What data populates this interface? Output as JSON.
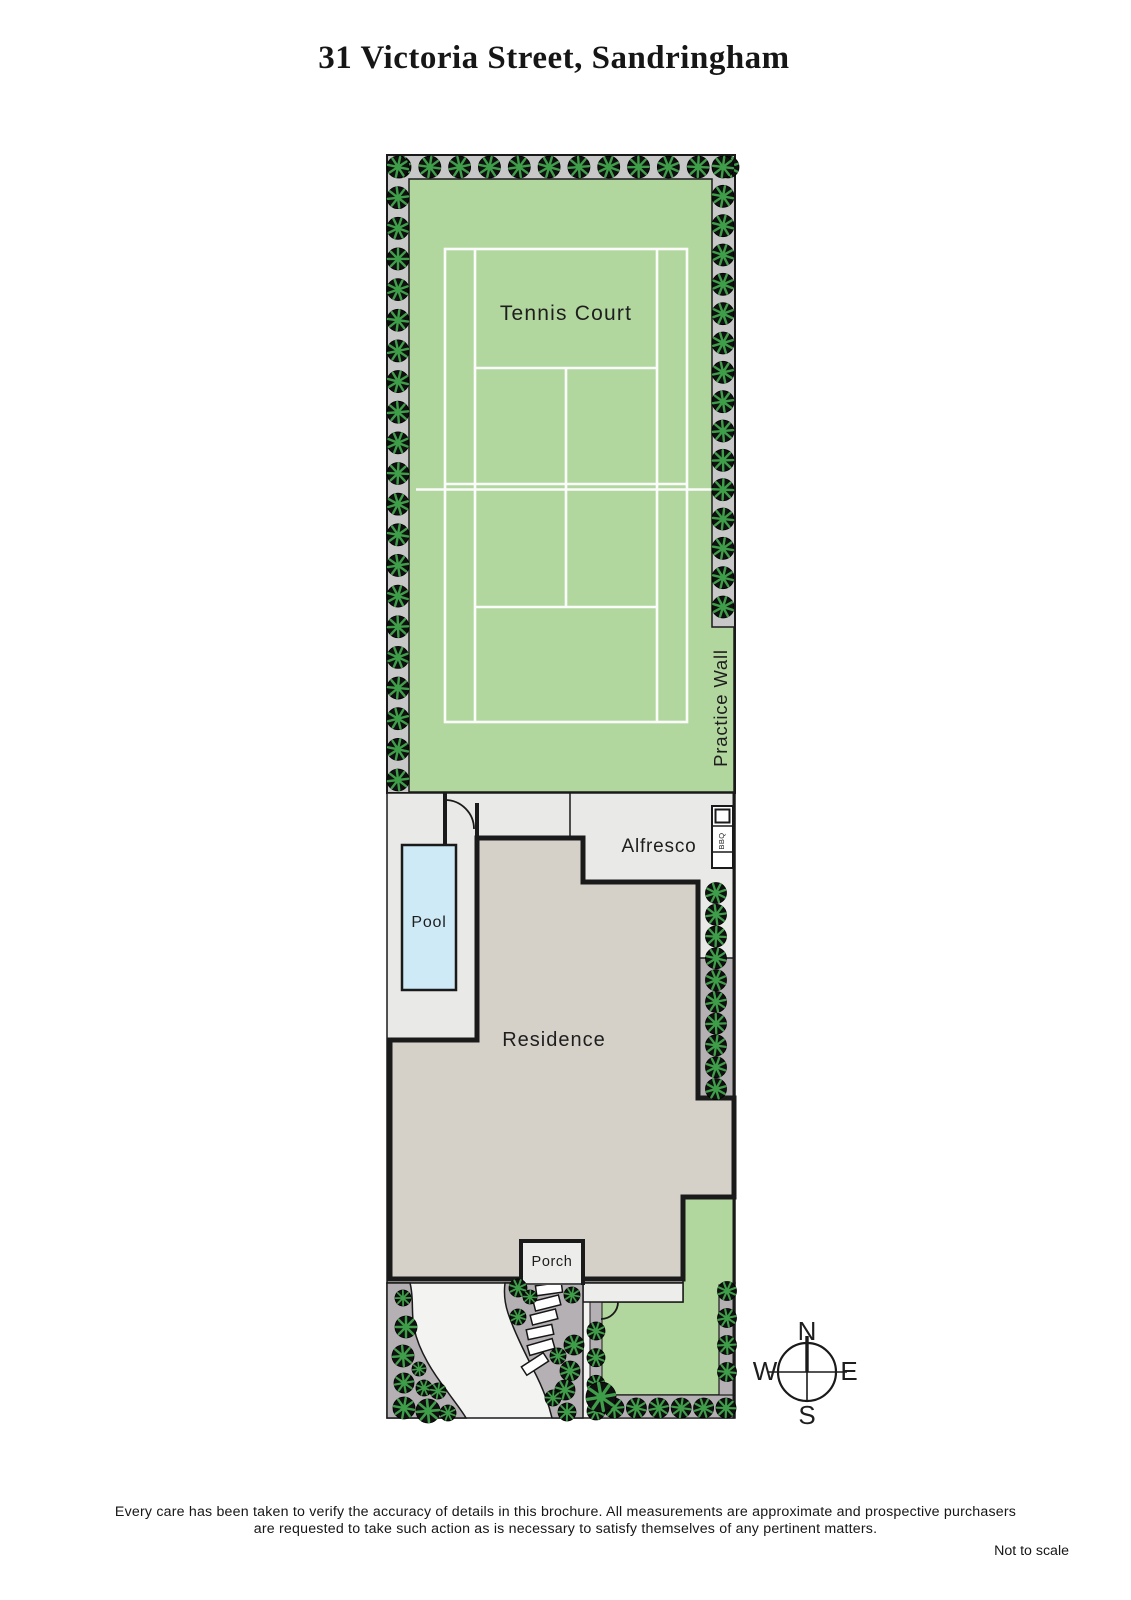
{
  "title": "31 Victoria Street, Sandringham",
  "labels": {
    "tennis_court": "Tennis Court",
    "practice_wall": "Practice Wall",
    "alfresco": "Alfresco",
    "bbq": "BBQ",
    "pool": "Pool",
    "residence": "Residence",
    "porch": "Porch"
  },
  "compass": {
    "north": "N",
    "south": "S",
    "east": "E",
    "west": "W"
  },
  "footer": {
    "disclaimer_line1": "Every care has been taken to verify the accuracy of details in this brochure.  All measurements are approximate and prospective purchasers",
    "disclaimer_line2": "are requested to take such action as is necessary to satisfy themselves of any pertinent matters.",
    "scale_note": "Not to scale"
  },
  "colors": {
    "lawn_green": "#b2d79e",
    "court_line": "#fbfbfb",
    "hedge_bed_gray": "#c8c8c8",
    "patio_gray": "#e9e9e7",
    "residence_gray": "#d5d1c9",
    "garden_bed_mauve": "#b5b0b3",
    "pool_blue": "#cdeaf6",
    "driveway_white": "#f3f3f2",
    "porch_white": "#ededeb",
    "outline_black": "#1a1a1a",
    "tree_green": "#3f9e49",
    "tree_dark": "#101010"
  },
  "vegetation": {
    "rows": [
      {
        "name": "hedge-top-row",
        "orient": "h",
        "y": 167,
        "from": 400,
        "to": 728,
        "count": 12,
        "r": 11
      },
      {
        "name": "hedge-west-column",
        "orient": "v",
        "x": 398,
        "from": 167,
        "to": 780,
        "count": 21,
        "r": 11
      },
      {
        "name": "hedge-east-column",
        "orient": "v",
        "x": 723,
        "from": 167,
        "to": 607,
        "count": 16,
        "r": 11
      },
      {
        "name": "east-garden-strip",
        "orient": "v",
        "x": 716,
        "from": 893,
        "to": 1089,
        "count": 10,
        "r": 10.5
      },
      {
        "name": "lawn-west-strip",
        "orient": "v",
        "x": 596,
        "from": 1331,
        "to": 1411,
        "count": 4,
        "r": 9
      },
      {
        "name": "south-lawn-row",
        "orient": "h",
        "y": 1408,
        "from": 614,
        "to": 726,
        "count": 6,
        "r": 10
      },
      {
        "name": "southeast-column",
        "orient": "v",
        "x": 727,
        "from": 1291,
        "to": 1372,
        "count": 4,
        "r": 9.5
      }
    ],
    "clusters": [
      {
        "name": "front-left-garden",
        "trees": [
          [
            403,
            1298,
            8
          ],
          [
            406,
            1327,
            11
          ],
          [
            403,
            1356,
            11
          ],
          [
            404,
            1383,
            10
          ],
          [
            419,
            1369,
            7
          ],
          [
            424,
            1388,
            8
          ],
          [
            438,
            1391,
            8
          ],
          [
            404,
            1408,
            11
          ],
          [
            428,
            1411,
            12
          ],
          [
            448,
            1413,
            8
          ]
        ]
      },
      {
        "name": "front-path-garden",
        "trees": [
          [
            518,
            1288,
            9
          ],
          [
            530,
            1297,
            7
          ],
          [
            518,
            1317,
            8
          ],
          [
            572,
            1295,
            8
          ],
          [
            574,
            1345,
            10
          ],
          [
            558,
            1356,
            8
          ],
          [
            570,
            1371,
            10
          ],
          [
            565,
            1390,
            10
          ],
          [
            553,
            1398,
            8
          ],
          [
            567,
            1412,
            9
          ]
        ]
      },
      {
        "name": "lawn-corner-tree",
        "trees": [
          [
            601,
            1397,
            15
          ]
        ]
      }
    ]
  },
  "stepping_stones": {
    "width": 26,
    "height": 10,
    "items": [
      [
        549,
        1289,
        -8
      ],
      [
        547,
        1303,
        -14
      ],
      [
        544,
        1317,
        -14
      ],
      [
        540,
        1332,
        -12
      ],
      [
        541,
        1347,
        -16
      ],
      [
        535,
        1364,
        -33
      ]
    ]
  }
}
